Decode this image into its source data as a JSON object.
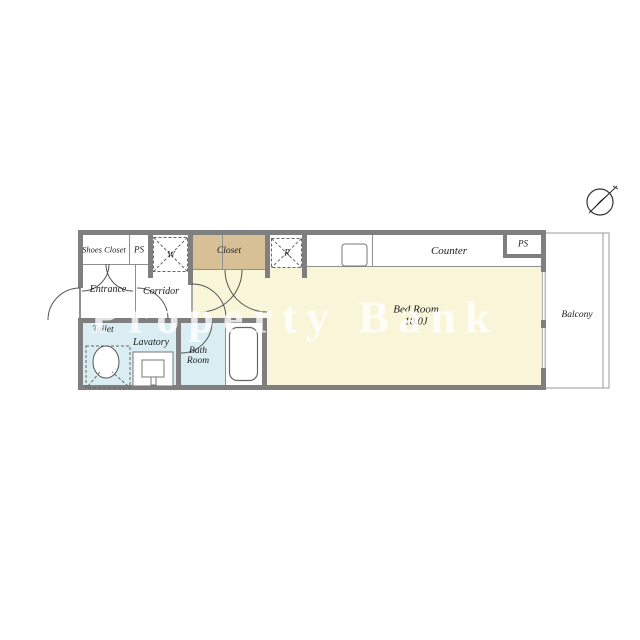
{
  "watermark": "Property Bank",
  "icons": {
    "compass": "north-arrow-icon"
  },
  "colors": {
    "wall": "#7f7f7f",
    "line": "#8f8f8f",
    "cream": "#f9f5d8",
    "tan": "#d8c096",
    "blue": "#d9edf3",
    "label": "#1c1c1c",
    "watermark": "rgba(255,255,255,0.78)"
  },
  "rooms": {
    "shoes_closet": "Shoes Closet",
    "ps_left": "PS",
    "washer": "W",
    "closet": "Closet",
    "refrigerator": "R",
    "counter": "Counter",
    "ps_right": "PS",
    "entrance": "Entrance",
    "corridor": "Corridor",
    "toilet": "Toilet",
    "lavatory": "Lavatory",
    "bath_line1": "Bath",
    "bath_line2": "Room",
    "bed_room": "Bed Room",
    "bed_room_size": "10.0J",
    "balcony": "Balcony"
  }
}
